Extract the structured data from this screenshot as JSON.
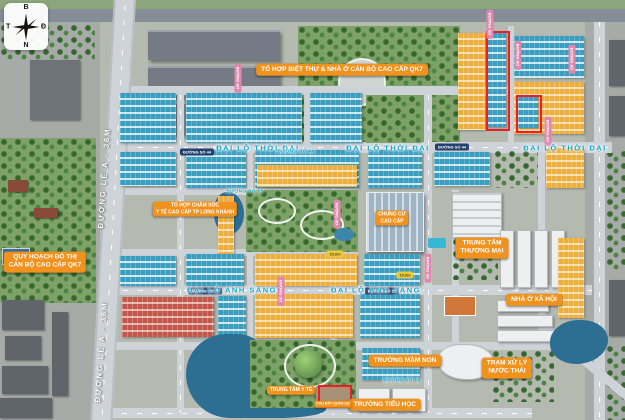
{
  "scene": {
    "type": "real-estate masterplan aerial render",
    "compass": {
      "top": "B",
      "right": "Đ",
      "bottom": "N",
      "left": "T"
    }
  },
  "area_labels": [
    {
      "id": "villa-complex-qk7",
      "text": "TỔ HỢP BIỆT THỰ & NHÀ Ở CÁN BỘ CAO CẤP QK7"
    },
    {
      "id": "urban-planning-qk7",
      "text": "QUY HOẠCH ĐÔ THỊ\nCÁN BỘ CAO CẤP QK7"
    },
    {
      "id": "medical-complex",
      "text": "TỔ HỢP CHĂM SÓC\nY TẾ CAO CẤP TP LONG KHÁNH"
    },
    {
      "id": "luxury-apartment",
      "text": "CHUNG CƯ\nCAO CẤP"
    },
    {
      "id": "trade-center",
      "text": "TRUNG TÂM\nTHƯƠNG MẠI"
    },
    {
      "id": "social-housing",
      "text": "NHÀ Ở XÃ HỘI"
    },
    {
      "id": "wastewater-plant",
      "text": "TRẠM XỬ LÝ\nNƯỚC THẢI"
    },
    {
      "id": "kindergarten",
      "text": "TRƯỜNG MẦM NON"
    },
    {
      "id": "primary-school",
      "text": "TRƯỜNG TIỂU HỌC"
    },
    {
      "id": "medical-center",
      "text": "TRUNG TÂM Y TẾ"
    },
    {
      "id": "military-plot",
      "text": "KHU ĐẤT QUÂN SỰ"
    }
  ],
  "road_labels": {
    "le_a": "ĐƯỜNG LÊ A - 36M",
    "thoi_dai": "ĐẠI LỘ THỜI ĐẠI",
    "anh_sang": "ĐẠI LỘ ÁNH SÁNG",
    "so_44": "ĐƯỜNG SỐ 44",
    "so_16": "ĐƯỜNG SỐ 16",
    "so_13": "ĐƯỜNG SỐ 13",
    "so_generic": "ĐƯỜNG SỐ",
    "width_15m": "15,0m"
  },
  "colors": {
    "label_bg": "#f0921e",
    "road_text": "#18a7c9",
    "teal_roofs": "#3b9ec0",
    "yellow_roofs": "#ecaf3e",
    "red_roofs": "#c2574b",
    "highlight_outline": "#ee1c24",
    "water": "#2c6f93",
    "park": "#7da167",
    "road": "#ced3d8"
  }
}
